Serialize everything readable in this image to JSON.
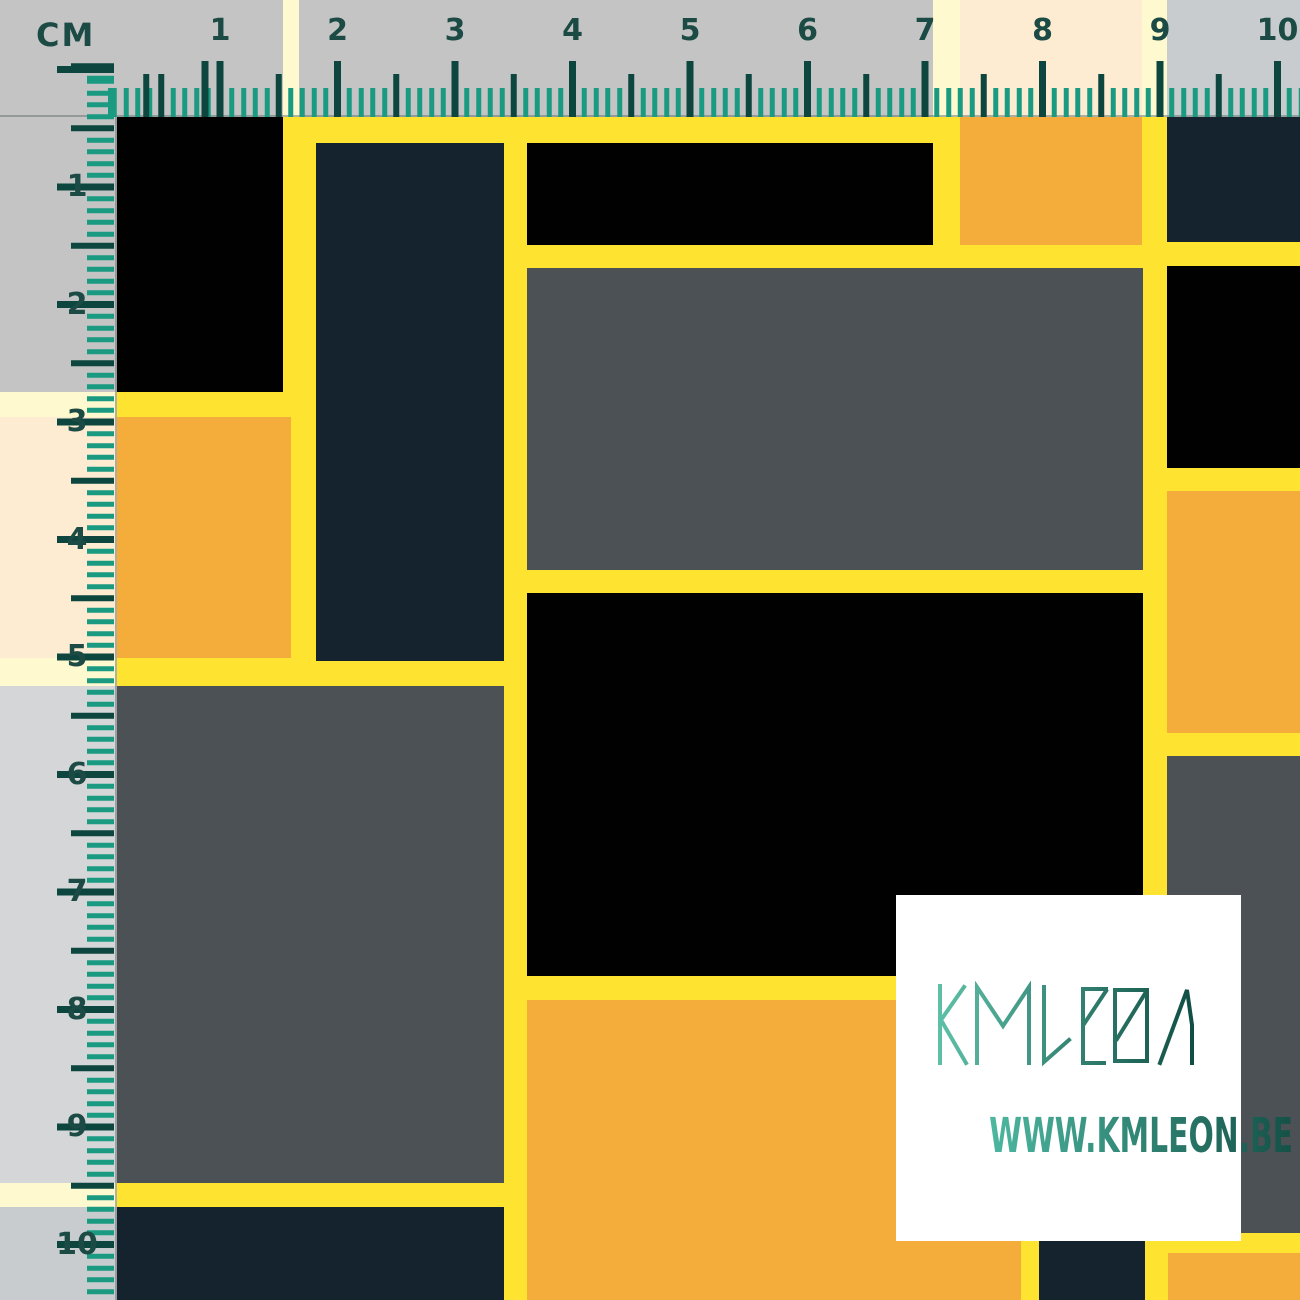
{
  "palette": {
    "yellow": "#FEE431",
    "orange": "#F4AC3B",
    "navy": "#14232E",
    "gray": "#4C5156",
    "black": "#010101"
  },
  "ruler": {
    "unit_label": "CM",
    "top_numbers": [
      "1",
      "2",
      "3",
      "4",
      "5",
      "6",
      "7",
      "8",
      "9",
      "10"
    ],
    "left_numbers": [
      "1",
      "2",
      "3",
      "4",
      "5",
      "6",
      "7",
      "8",
      "9",
      "10"
    ],
    "cm_px": 117.5,
    "top_origin_px": 102.5,
    "left_origin_px": 69.5,
    "minor_tick_color": "#1A9A81",
    "major_tick_color": "#0C463F",
    "number_color": "#1B4B44",
    "overlay_color": "rgba(255,255,255,0.77)"
  },
  "pattern": {
    "background": "yellow",
    "rects": [
      {
        "x": 0,
        "y": 0,
        "w": 283,
        "h": 392,
        "c": "black"
      },
      {
        "x": 299,
        "y": 0,
        "w": 634,
        "h": 117,
        "c": "black"
      },
      {
        "x": 316,
        "y": 143,
        "w": 188,
        "h": 518,
        "c": "navy"
      },
      {
        "x": 527,
        "y": 143,
        "w": 406,
        "h": 102,
        "c": "black"
      },
      {
        "x": 960,
        "y": 0,
        "w": 182,
        "h": 245,
        "c": "orange"
      },
      {
        "x": 1167,
        "y": 0,
        "w": 133,
        "h": 242,
        "c": "navy"
      },
      {
        "x": 0,
        "y": 417,
        "w": 291,
        "h": 241,
        "c": "orange"
      },
      {
        "x": 527,
        "y": 268,
        "w": 616,
        "h": 302,
        "c": "gray"
      },
      {
        "x": 1167,
        "y": 266,
        "w": 133,
        "h": 202,
        "c": "black"
      },
      {
        "x": 1167,
        "y": 491,
        "w": 133,
        "h": 242,
        "c": "orange"
      },
      {
        "x": 527,
        "y": 593,
        "w": 616,
        "h": 383,
        "c": "black"
      },
      {
        "x": 0,
        "y": 686,
        "w": 504,
        "h": 497,
        "c": "gray"
      },
      {
        "x": 1167,
        "y": 756,
        "w": 133,
        "h": 477,
        "c": "gray"
      },
      {
        "x": 527,
        "y": 1000,
        "w": 494,
        "h": 300,
        "c": "orange"
      },
      {
        "x": 0,
        "y": 1207,
        "w": 504,
        "h": 93,
        "c": "navy"
      },
      {
        "x": 1039,
        "y": 1207,
        "w": 106,
        "h": 93,
        "c": "navy"
      },
      {
        "x": 1168,
        "y": 1253,
        "w": 132,
        "h": 47,
        "c": "orange"
      }
    ]
  },
  "card": {
    "brand": "KMLEON",
    "website": "WWW.KMLEON.BE",
    "background": "#FFFFFF",
    "logo_gradient": [
      "#5FC2A9",
      "#0D4A40"
    ],
    "website_gradient": [
      "#4DB7A0",
      "#145147"
    ]
  }
}
